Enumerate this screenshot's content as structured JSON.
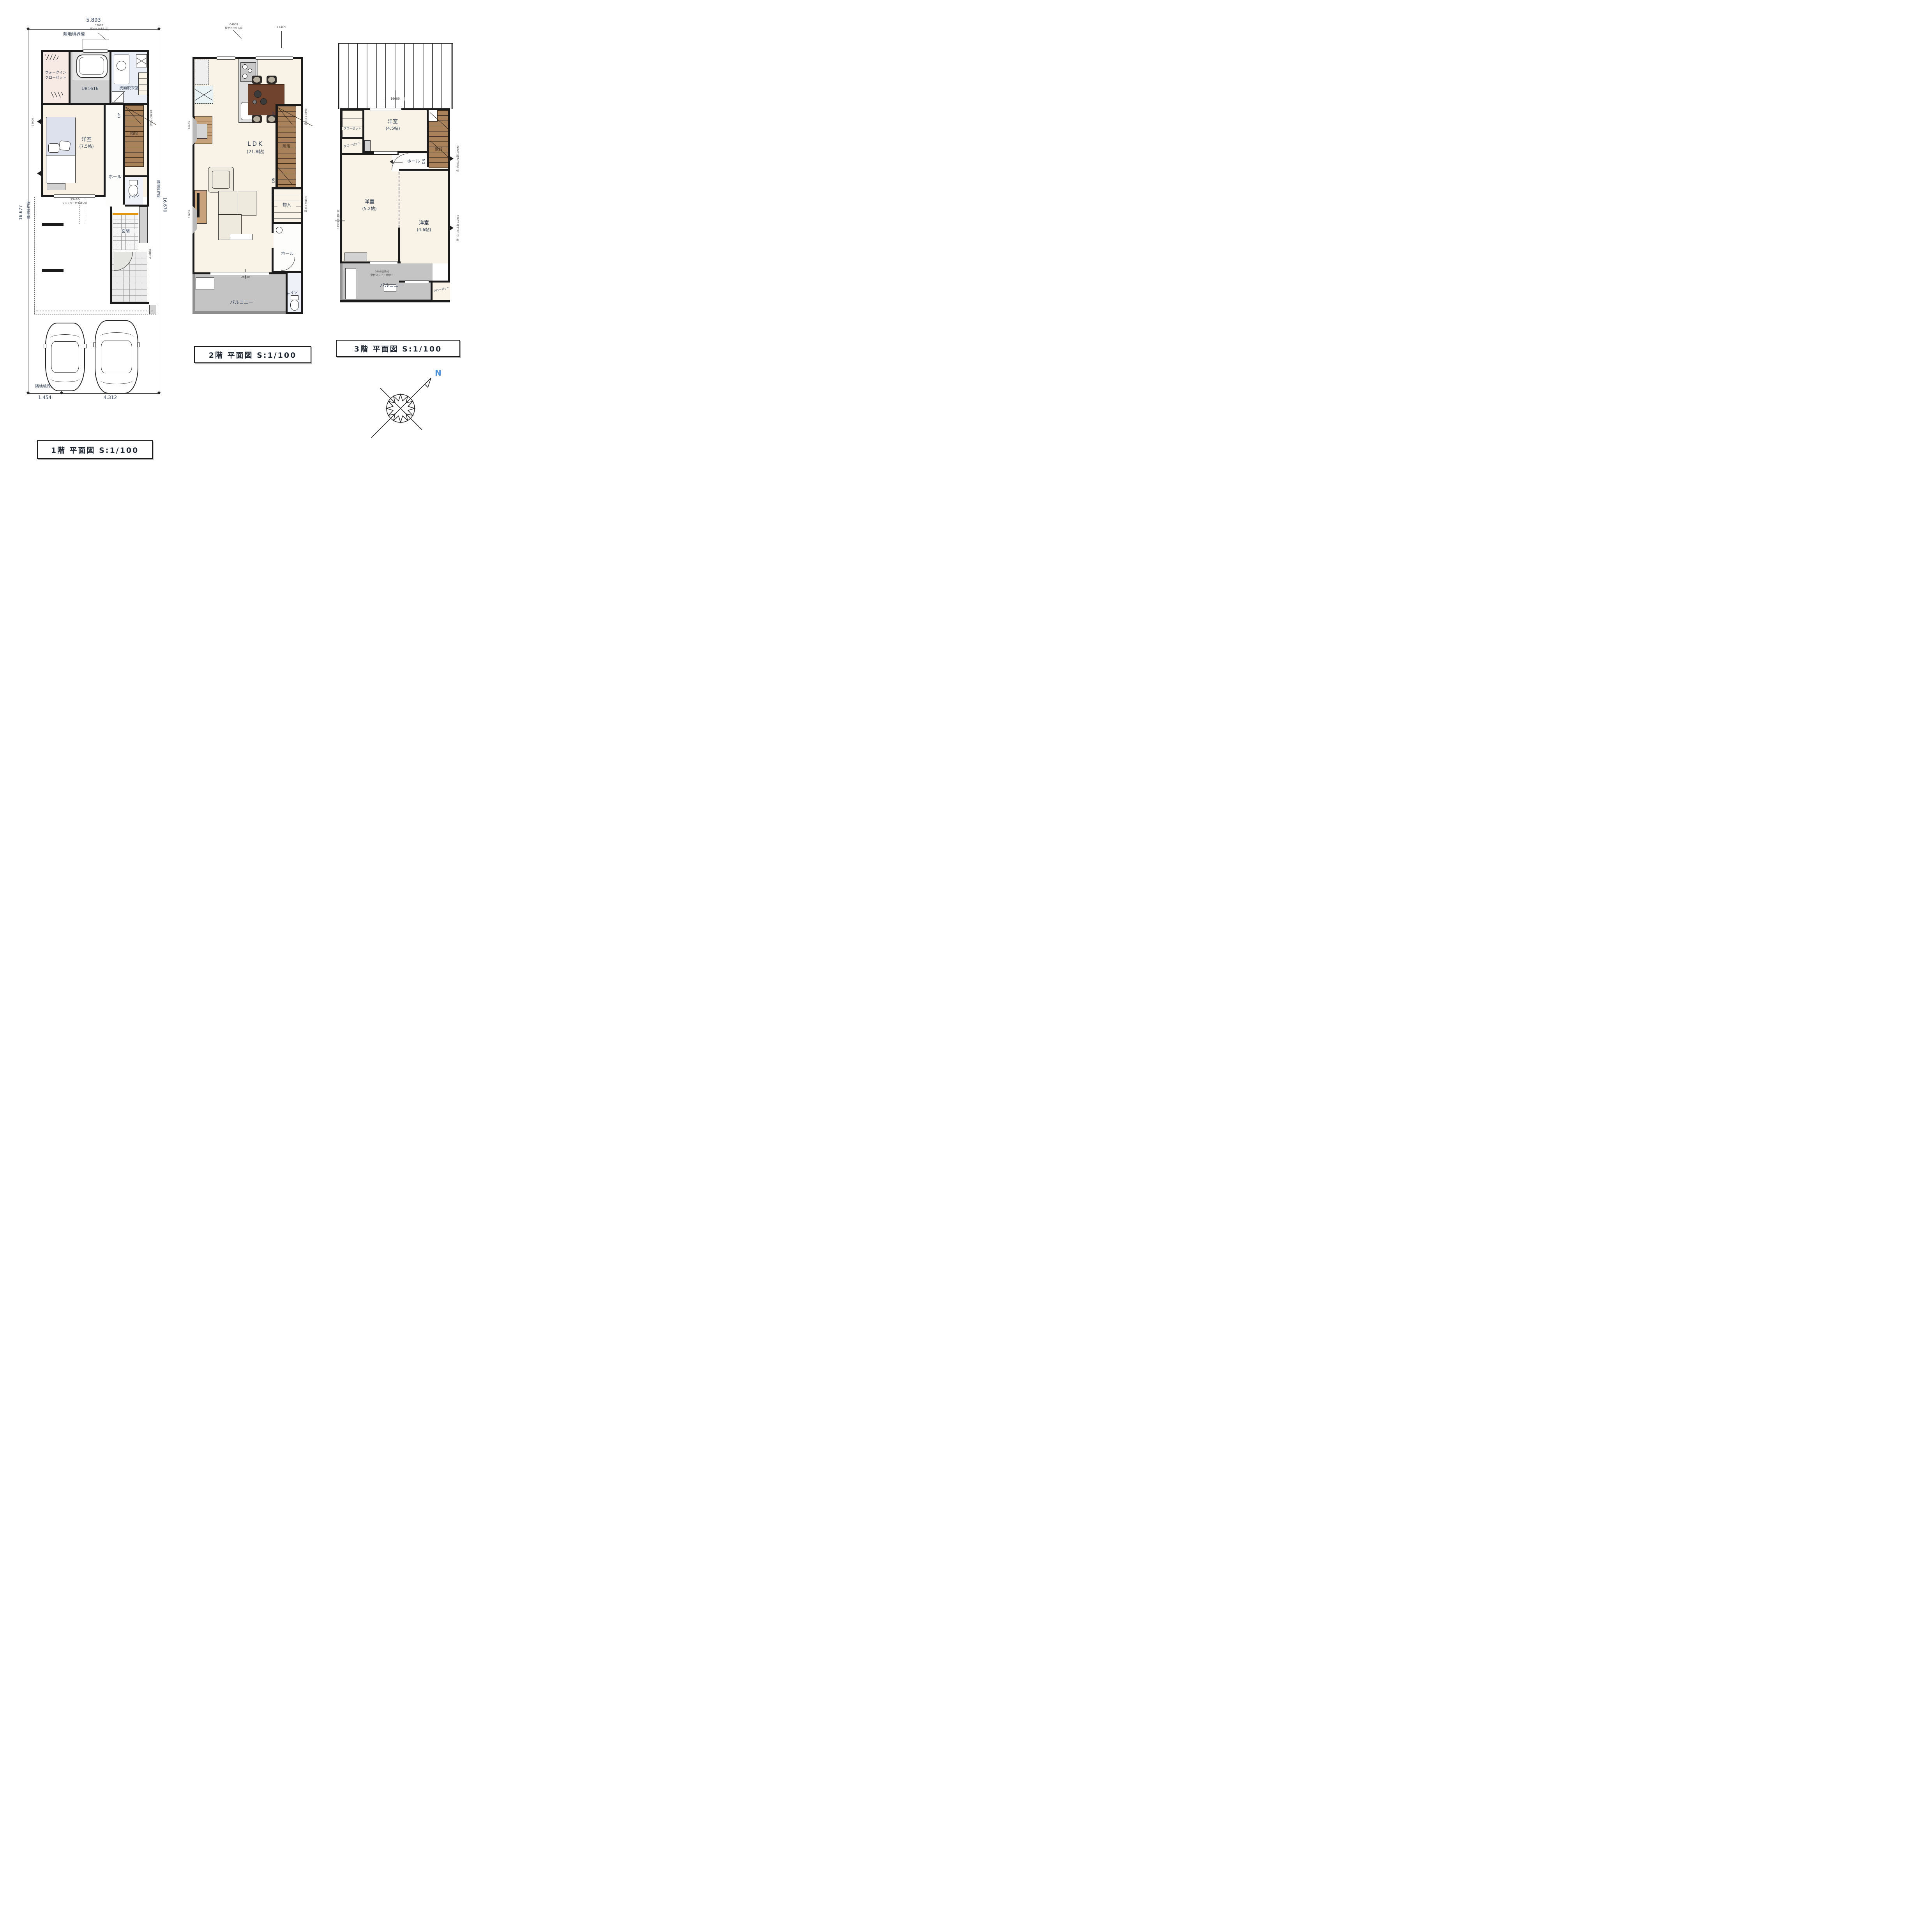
{
  "f1": {
    "title": "1階 平面図 S:1/100",
    "boundary": "隣地境界線",
    "dim_top": "5.893",
    "dim_left": "16.677",
    "dim_right": "16.670",
    "dim_b1": "1.454",
    "dim_b2": "4.312",
    "wic_l1": "ウォークイン",
    "wic_l2": "クローゼット",
    "ub": "UB1616",
    "wash": "洗面脱衣室",
    "bed": "洋室",
    "bed_size": "(7.5帖)",
    "hall": "ホール",
    "stairs": "階段",
    "up": "UP",
    "toilet": "トイレ",
    "genkan": "玄関",
    "win_top_code": "03607",
    "win_top_name": "縦すべり出し窓",
    "fix_code": "06807",
    "fix_name": "FIX窓",
    "win_main_code": "15420",
    "win_main_name": "シャッター付引違い窓",
    "win_left_code": "16009",
    "door_name": "玄関ドア"
  },
  "f2": {
    "title": "2階 平面図 S:1/100",
    "ldk": "LDK",
    "ldk_size": "(21.8帖)",
    "hall": "ホール",
    "stairs": "階段",
    "up": "UP",
    "dn": "DN",
    "toilet": "トイレ",
    "storage": "物入",
    "balcony": "バルコニー",
    "win_top_code": "04609",
    "win_top_name": "縦すべり出し窓",
    "win_top2_code": "11409",
    "fix_code": "06807",
    "fix_name": "FIX窓",
    "balc_win_code": "25420",
    "win_left_code": "16009"
  },
  "f3": {
    "title": "3階 平面図 S:1/100",
    "roof_code": "16609",
    "closet": "クローゼット",
    "r45": "洋室",
    "r45_size": "(4.5帖)",
    "r52": "洋室",
    "r52_size": "(5.2帖)",
    "r46": "洋室",
    "r46_size": "(4.6帖)",
    "hall": "ホール",
    "stairs": "階段",
    "dn": "DN",
    "balcony": "バルコニー",
    "win_right_code": "06807",
    "win_right_name": "縦すべり出し窓",
    "win_left_code": "11909",
    "win_left_name": "引違い窓",
    "laundry1": "0808格子付",
    "laundry2": "壁付スライド式物干"
  },
  "compass": {
    "north": "N"
  }
}
